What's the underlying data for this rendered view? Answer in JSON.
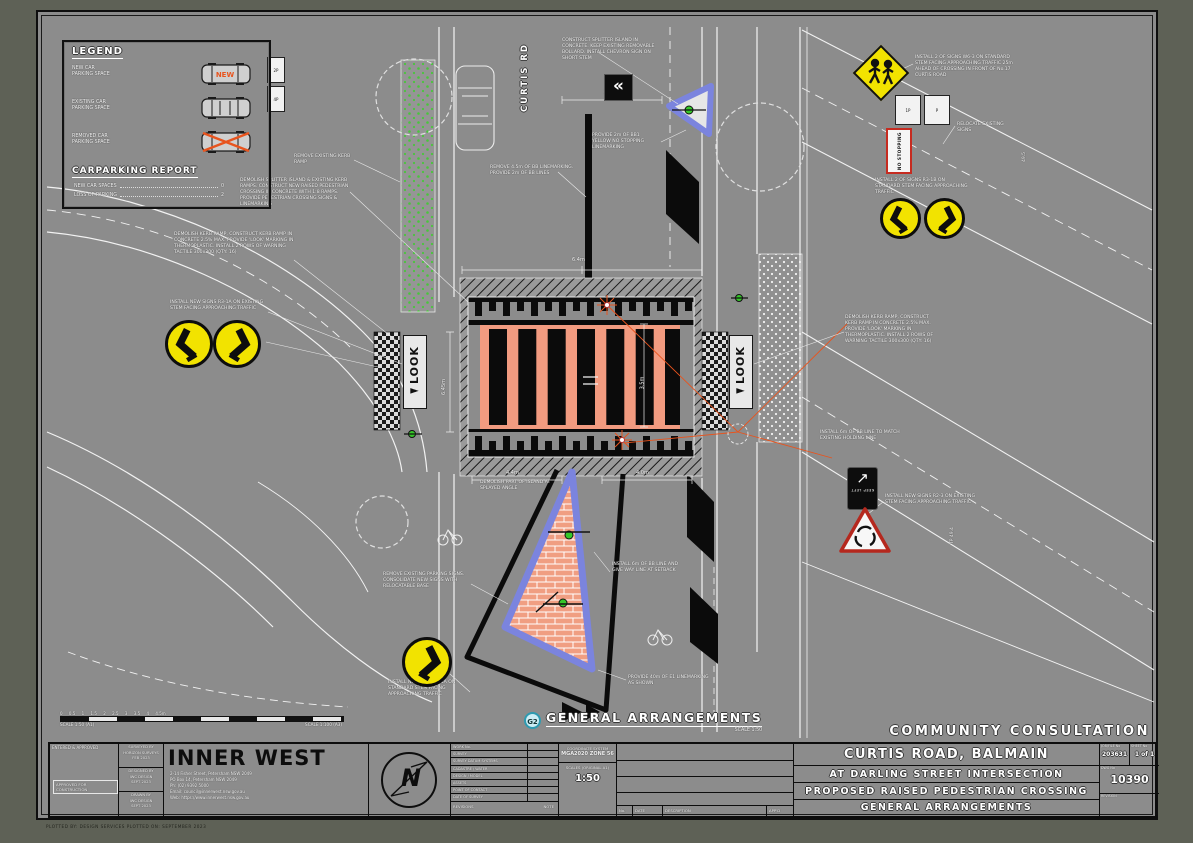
{
  "colors": {
    "sheet_gray": "#8c8c8c",
    "salmon": "#f29b80",
    "kerb_blue": "#7b84de",
    "sign_yellow": "#f2e300",
    "accent_orange": "#e8541e",
    "marker_green": "#35c829",
    "badge_cyan": "#2e9ab0"
  },
  "legend": {
    "title": "LEGEND",
    "items": [
      {
        "l1": "NEW CAR",
        "l2": "PARKING SPACE",
        "tag": "NEW"
      },
      {
        "l1": "EXISTING CAR",
        "l2": "PARKING SPACE",
        "tag": ""
      },
      {
        "l1": "REMOVED CAR",
        "l2": "PARKING SPACE",
        "tag": ""
      }
    ],
    "report_title": "CARPARKING REPORT",
    "report_rows": [
      {
        "label": "NEW CAR SPACES",
        "value": "0"
      },
      {
        "label": "LOSS OF PARKING",
        "value": "2"
      }
    ]
  },
  "plan": {
    "street_label": "CURTIS RD",
    "look_left": "◄LOOK",
    "look_right": "◄LOOK",
    "detail_badge": "G2",
    "detail_title": "GENERAL ARRANGEMENTS",
    "detail_scale": "SCALE 1:50",
    "consultation": "COMMUNITY  CONSULTATION",
    "scalebar_ticks": "0     0.5     1     1.5     2     2.5     3     3.5     4     4.5m",
    "scalebar_left": "SCALE 1:50 (A1)",
    "scalebar_right": "SCALE 1:100 (A3)",
    "signs": {
      "chevron": "«",
      "no_stopping": "NO STOPPING",
      "keep_left_arrow": "↗",
      "keep_left": "KEEP LEFT",
      "parking_a": "2P",
      "parking_b": "4P",
      "parking_c": "1P",
      "parking_d": "P"
    },
    "annotations": [
      "DEMOLISH SPLITTER ISLAND & EXISTING KERB RAMPS. CONSTRUCT NEW RAISED PEDESTRIAN CROSSING IN CONCRETE WITH 1:8 RAMPS. PROVIDE PEDESTRIAN CROSSING SIGNS & LINEMARKING",
      "DEMOLISH KERB RAMP, CONSTRUCT KERB RAMP IN CONCRETE 2.5% MAX. PROVIDE 'LOOK' MARKING IN THERMOPLASTIC. INSTALL 2 ROWS OF WARNING TACTILE 300x300 (QTY: 16)",
      "INSTALL NEW SIGNS R3-1A ON EXISTING STEM FACING APPROACHING TRAFFIC",
      "REMOVE EXISTING KERB RAMP",
      "REMOVE 4.5m OF BB LINEMARKING. PROVIDE 2m OF BB LINES",
      "CONSTRUCT SPLITTER ISLAND IN CONCRETE. KEEP EXISTING REMOVABLE BOLLARD. INSTALL CHEVRON SIGN ON SHORT STEM",
      "PROVIDE 2m OF BB1 YELLOW NO STOPPING LINEMARKING",
      "INSTALL 2 OF SIGNS W6-3 ON STANDARD STEM FACING APPROACHING TRAFFIC 25m AHEAD OF CROSSING IN FRONT OF No.17 CURTIS ROAD",
      "RELOCATE EXISTING SIGNS",
      "INSTALL 2 OF SIGNS R3-1B ON STANDARD STEM FACING APPROACHING TRAFFIC",
      "DEMOLISH KERB RAMP, CONSTRUCT KERB RAMP IN CONCRETE 2.5% MAX. PROVIDE 'LOOK' MARKING IN THERMOPLASTIC. INSTALL 2 ROWS OF WARNING TACTILE 300x300 (QTY: 16)",
      "INSTALL 6m OF BB LINE TO MATCH EXISTING HOLDING LINE",
      "INSTALL NEW SIGNS R2-3 ON EXISTING STEM FACING APPROACHING TRAFFIC",
      "INSTALL 6m OF BB LINE AND GIVE WAY LINE AT SETBACK",
      "REMOVE EXISTING PARKING SIGNS. CONSOLIDATE NEW SIGNS WITH RELOCATABLE BASE",
      "INSTALL NEW SIGN R3-1A ON STANDARD STEM FACING APPROACHING TRAFFIC",
      "PROVIDE 40m OF E1 LINEMARKING AS SHOWN",
      "DEMOLISH PART OF ISLAND AT SPLAYED ANGLE"
    ],
    "dims": [
      "2.4m",
      "6.4m",
      "6.45m",
      "3.5m",
      "4.4m",
      "4.0m"
    ],
    "levels": [
      "TP 49.4",
      "49.5"
    ]
  },
  "title_block": {
    "approvals": {
      "entered": "ENTERED & APPROVED",
      "construction": "APPROVED FOR CONSTRUCTION"
    },
    "prepared": [
      {
        "l1": "SURVEYED BY",
        "l2": "HORIZON SURVEYS",
        "l3": "FEB 2023"
      },
      {
        "l1": "DESIGNED BY",
        "l2": "IWC DESIGN",
        "l3": "SEPT 2023"
      },
      {
        "l1": "DRAWN BY",
        "l2": "IWC DESIGN",
        "l3": "SEPT 2023"
      }
    ],
    "org": {
      "name": "INNER WEST",
      "address": "2-14 Fisher Street, Petersham NSW 2049\nPO Box 14, Petersham NSW 2049\nPh:    (02) 9392 5000\nEmail: council@innerwest.nsw.gov.au\nWeb:   https://www.innerwest.nsw.gov.au"
    },
    "north_letter": "N",
    "fields": [
      "WORK No.",
      "SURVEY",
      "SURVEY DATUM SYSTEMS",
      "CADASTRE / WATER",
      "DESIGN / MODEL",
      "ASSETS",
      "POINT OF CONTACT",
      "DATE OF SURVEY"
    ],
    "fields_footer": {
      "left": "REVISIONS",
      "right": "NOTE"
    },
    "coord": {
      "label": "COORDINATE SYSTEM",
      "value": "MGA2020 ZONE 56",
      "scales_label": "SCALES (ORIGINAL A1)",
      "scales_value": "1:50"
    },
    "rev_headers": [
      "No.",
      "DATE",
      "DESCRIPTION",
      "APP'D"
    ],
    "project": {
      "line1": "CURTIS ROAD, BALMAIN",
      "line2": "AT DARLING STREET INTERSECTION",
      "line3": "PROPOSED RAISED PEDESTRIAN CROSSING",
      "line4": "GENERAL ARRANGEMENTS"
    },
    "numbers": {
      "job_label": "JOB/FILE No",
      "job": "203631",
      "sheet_label": "SHEET No",
      "sheet": "1 of 1",
      "dwg_label": "DWG No",
      "dwg": "10390",
      "rev_label": "REVISION",
      "rev": ""
    },
    "footer": "PLOTTED BY: DESIGN SERVICES          PLOTTED ON: SEPTEMBER 2023"
  }
}
